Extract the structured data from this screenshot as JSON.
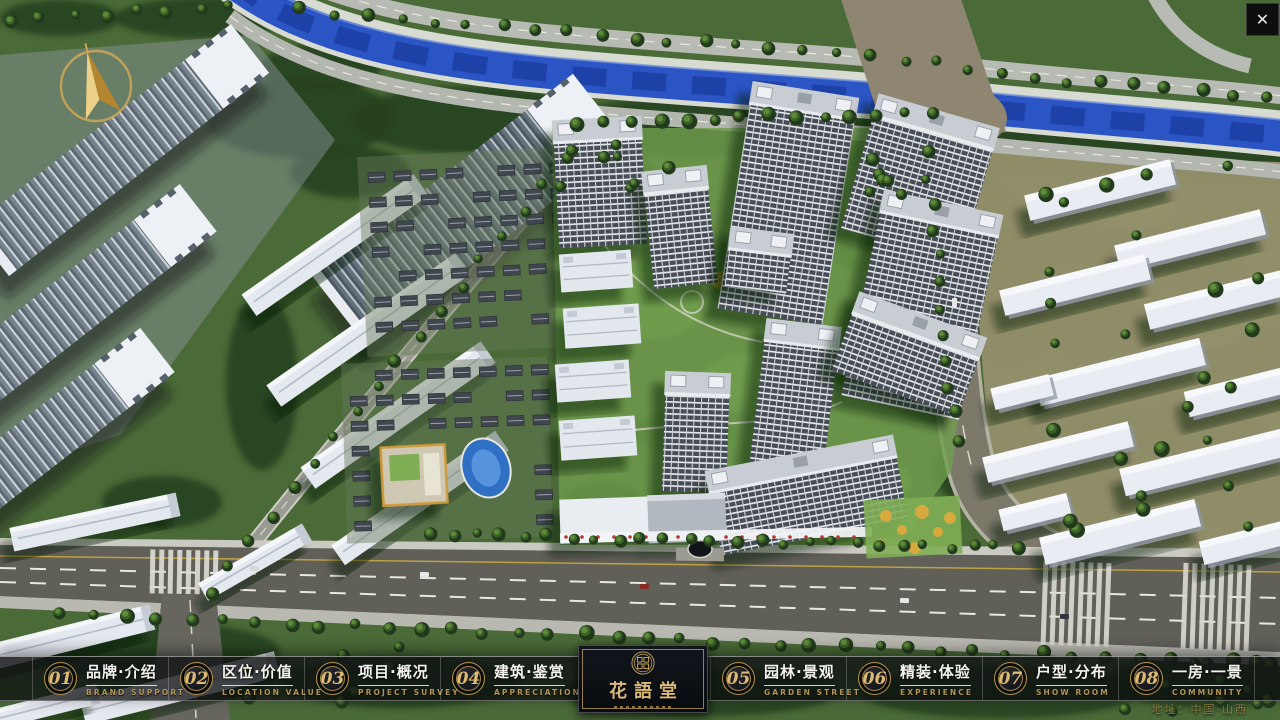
{
  "ui": {
    "close_icon": "✕",
    "accent_gold": "#C8A35C",
    "bar_background": "#0D1013",
    "river_blue": "#2B55C4"
  },
  "nav": {
    "items": [
      {
        "number": "01",
        "title": "品牌·介绍",
        "subtitle": "BRAND SUPPORT"
      },
      {
        "number": "02",
        "title": "区位·价值",
        "subtitle": "LOCATION VALUE"
      },
      {
        "number": "03",
        "title": "项目·概况",
        "subtitle": "PROJECT SURVEY"
      },
      {
        "number": "04",
        "title": "建筑·鉴赏",
        "subtitle": "APPRECIATION"
      },
      {
        "number": "05",
        "title": "园林·景观",
        "subtitle": "GARDEN STREET"
      },
      {
        "number": "06",
        "title": "精装·体验",
        "subtitle": "EXPERIENCE"
      },
      {
        "number": "07",
        "title": "户型·分布",
        "subtitle": "SHOW ROOM"
      },
      {
        "number": "08",
        "title": "一房·一景",
        "subtitle": "COMMUNITY"
      }
    ],
    "logo": {
      "title": "花語堂"
    }
  },
  "footer": {
    "address": "地址：中国·山西"
  }
}
